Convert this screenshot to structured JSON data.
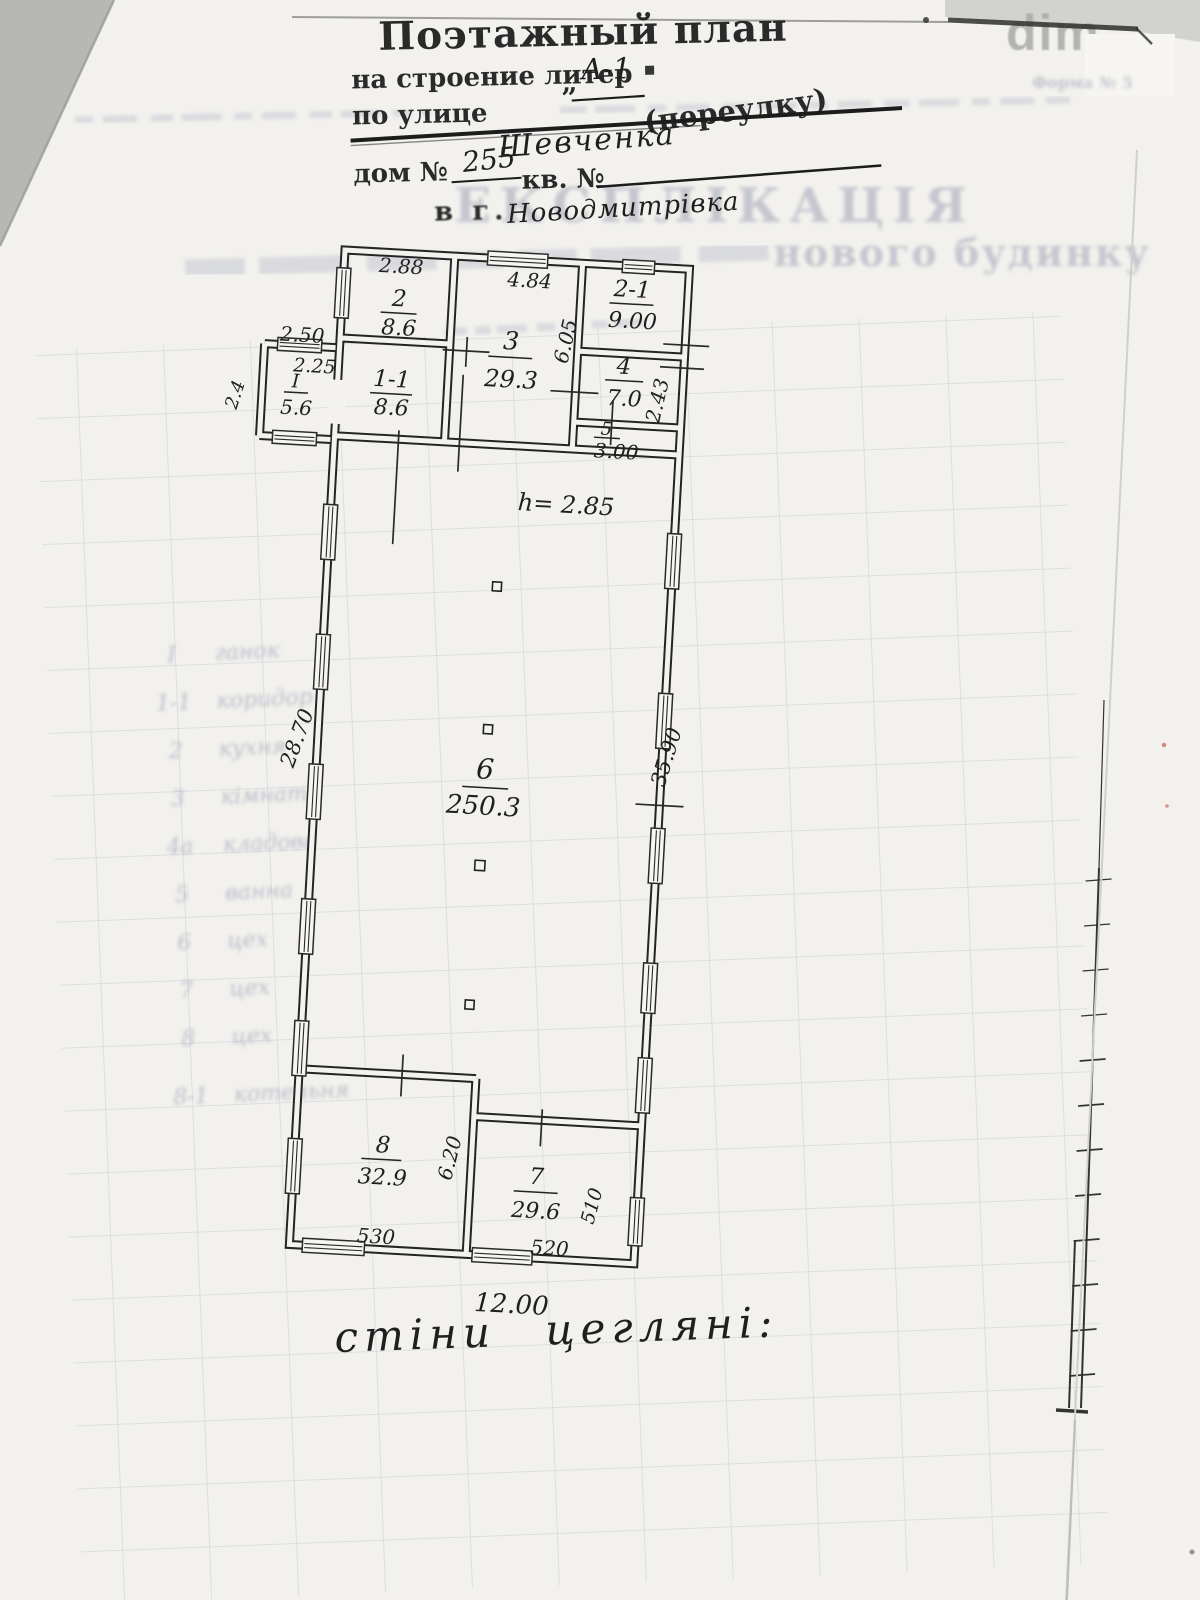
{
  "watermark": "dim",
  "header": {
    "title": "Поэтажный план",
    "building_label": "на строение литер",
    "building_quote_open": "„",
    "building_value": "А-1",
    "street_label_1": "по улице",
    "street_label_2": "(переулку)",
    "street_value": "Шевченка",
    "house_label": "дом №",
    "house_value": "255",
    "apt_label": "кв. №",
    "city_label": "в г.",
    "city_value": "Новодмитрівка"
  },
  "ghost": {
    "form_note": "Форма № 5",
    "explication_title": "ЕКСПЛІКАЦІЯ",
    "explication_tail": "нового будинку",
    "rows": [
      {
        "num": "I",
        "label": "ганок"
      },
      {
        "num": "1-1",
        "label": "коридор"
      },
      {
        "num": "2",
        "label": "кухня"
      },
      {
        "num": "3",
        "label": "кімната"
      },
      {
        "num": "4а",
        "label": "кладова"
      },
      {
        "num": "5",
        "label": "ванна"
      },
      {
        "num": "6",
        "label": "цех"
      },
      {
        "num": "7",
        "label": "цех"
      },
      {
        "num": "8",
        "label": "цех"
      },
      {
        "num": "8-1",
        "label": "котельня"
      }
    ]
  },
  "plan": {
    "height_note": "h= 2.85",
    "walls_note": "стіни цегляні:",
    "rooms": {
      "r2": {
        "num": "2",
        "area": "8.6"
      },
      "r11": {
        "num": "1-1",
        "area": "8.6"
      },
      "r3": {
        "num": "3",
        "area": "29.3"
      },
      "r21": {
        "num": "2-1",
        "area": "9.00"
      },
      "r4": {
        "num": "4",
        "area": "7.0"
      },
      "r5": {
        "num": "5",
        "area": "3.00"
      },
      "rI": {
        "num": "I",
        "area": "5.6"
      },
      "r6": {
        "num": "6",
        "area": "250.3"
      },
      "r8": {
        "num": "8",
        "area": "32.9"
      },
      "r7": {
        "num": "7",
        "area": "29.6"
      }
    },
    "dims": {
      "room2_width": "2.88",
      "room3_width": "4.84",
      "room3_height": "6.05",
      "porch_width": "2.50",
      "porch_inner": "2.25",
      "porch_depth": "2.4",
      "room4_height": "2.43",
      "left_wall": "28.70",
      "right_wall": "35.90",
      "room8_width": "530",
      "room8_height": "6.20",
      "room7_width": "520",
      "room7_height": "510",
      "total_width": "12.00"
    }
  }
}
